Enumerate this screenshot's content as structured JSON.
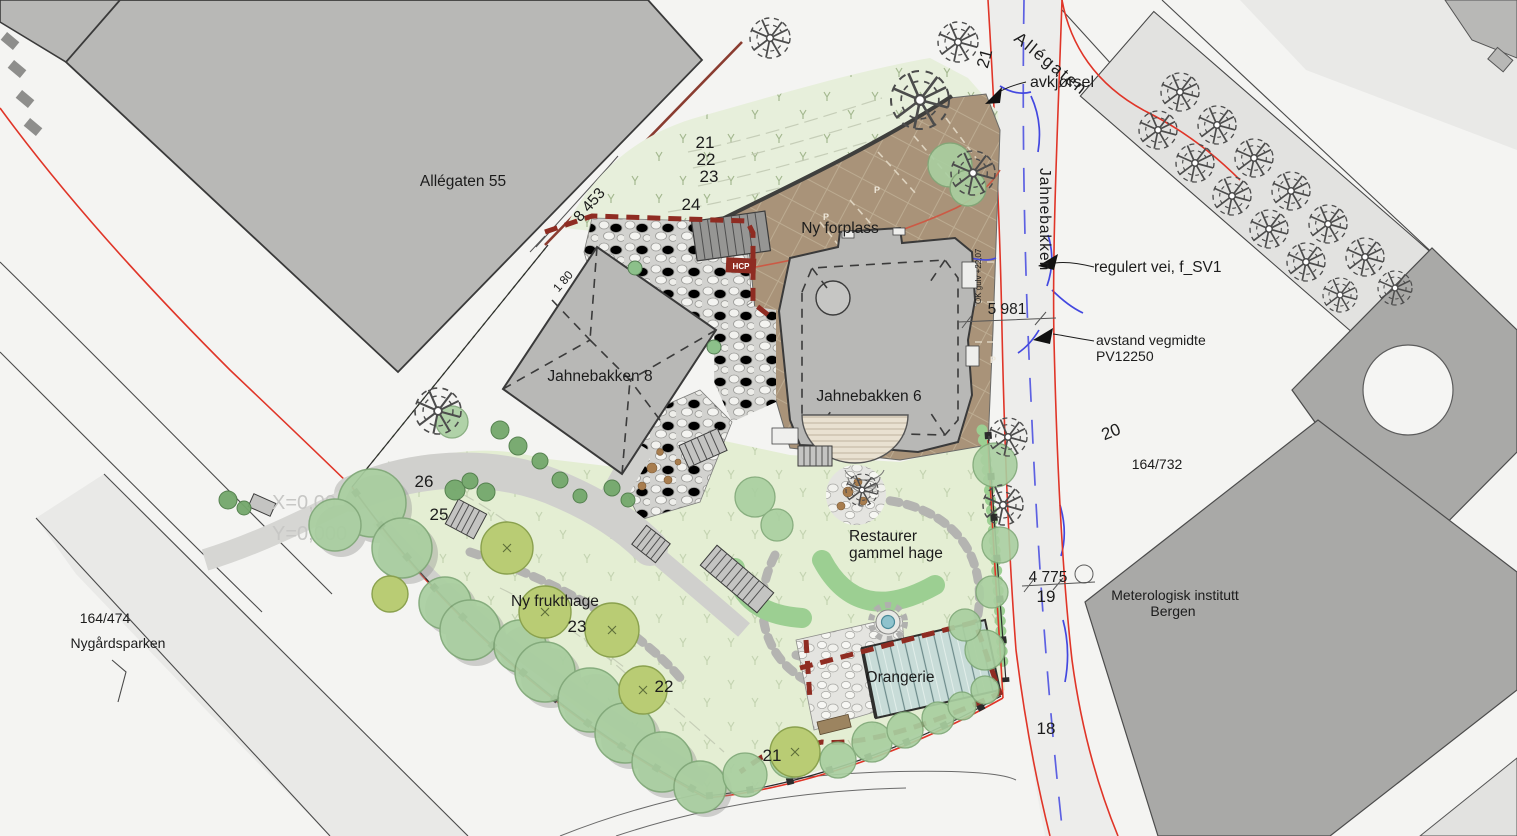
{
  "plan": {
    "streets": {
      "allegaten": "Allégaten",
      "jahnebakken": "Jahnebakken"
    },
    "buildings": {
      "allegaten55": "Allégaten 55",
      "jahnebakken8": "Jahnebakken 8",
      "jahnebakken6": "Jahnebakken 6",
      "met_line1": "Meterologisk institutt",
      "met_line2": "Bergen",
      "orangerie": "Orangerie"
    },
    "areas": {
      "ny_forplass": "Ny forplass",
      "restaurer_line1": "Restaurer",
      "restaurer_line2": "gammel hage",
      "ny_frukthage": "Ny frukthage",
      "nygardsparken": "Nygårdsparken"
    },
    "annotations": {
      "avkjorsel": "avkjørsel",
      "regulert_vei": "regulert vei, f_SV1",
      "avstand_line1": "avstand vegmidte",
      "avstand_line2": "PV12250",
      "hcp": "HCP",
      "ok_gulv": "OK gulv +22,07",
      "coord_x": "X=0,00",
      "coord_y": "Y=0,000"
    },
    "dimensions": {
      "d8453": "8 453",
      "d5981": "5 981",
      "d4775": "4 775",
      "d180": "1 80"
    },
    "parcels": {
      "p164_732": "164/732",
      "p164_474": "164/474"
    },
    "contours": {
      "c21_street": "21",
      "c21_upper": "21",
      "c22_upper": "22",
      "c23_upper": "23",
      "c24": "24",
      "c25": "25",
      "c26": "26",
      "c23_lower": "23",
      "c22_lower": "22",
      "c21_lower": "21",
      "c20": "20",
      "c19": "19",
      "c18": "18"
    },
    "markers": {
      "parking": "P"
    }
  },
  "colors": {
    "bg": "#f4f4f2",
    "parcel": "#e9e9e7",
    "parcel_dark": "#e2e2e0",
    "building": "#b8b8b6",
    "building_dark": "#a9a9a7",
    "outline": "#3a3a3a",
    "lawn": "#e7efdb",
    "lawn_bright": "#e4eed3",
    "tree": "#a9cfa0",
    "tree_edge": "#7fa877",
    "tree_olive": "#b9cc74",
    "olive_edge": "#8aa14e",
    "shrub": "#74a86c",
    "hedge": "#9ccf92",
    "gravel": "#d0d0cd",
    "cobble_bg": "#d9d9d6",
    "forecourt": "#a99379",
    "forecourt_line": "#c3b097",
    "deck": "#e9e1d1",
    "glass": "#c8dcd8",
    "water": "#8fc3cd",
    "red_line": "#e03528",
    "red_dash": "#8f2c22",
    "blue_line": "#4348e0",
    "salmon": "#cc5a45",
    "dim": "#555555",
    "label": "#1c1c1c",
    "label_faint": "#c7c7c5"
  }
}
